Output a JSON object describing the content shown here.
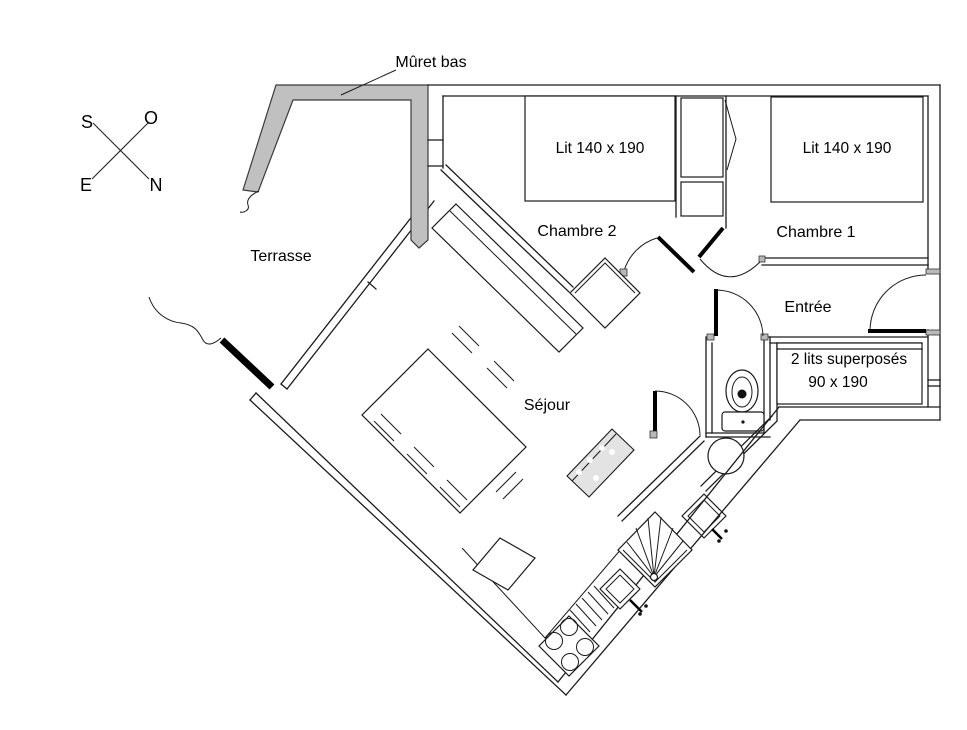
{
  "labels": {
    "muret": "Mûret bas",
    "terrasse": "Terrasse",
    "chambre2": "Chambre 2",
    "lit_chambre2": "Lit 140 x 190",
    "chambre1": "Chambre 1",
    "lit_chambre1": "Lit 140 x 190",
    "entree": "Entrée",
    "sejour": "Séjour",
    "bunk_line1": "2 lits superposés",
    "bunk_line2": "90 x 190"
  },
  "compass": {
    "south": "S",
    "west": "O",
    "east": "E",
    "north": "N"
  },
  "colors": {
    "wall": "#1a1a1a",
    "muret_fill": "#c0c0c0",
    "background": "#ffffff",
    "bar_fill": "#e3e3e3"
  }
}
